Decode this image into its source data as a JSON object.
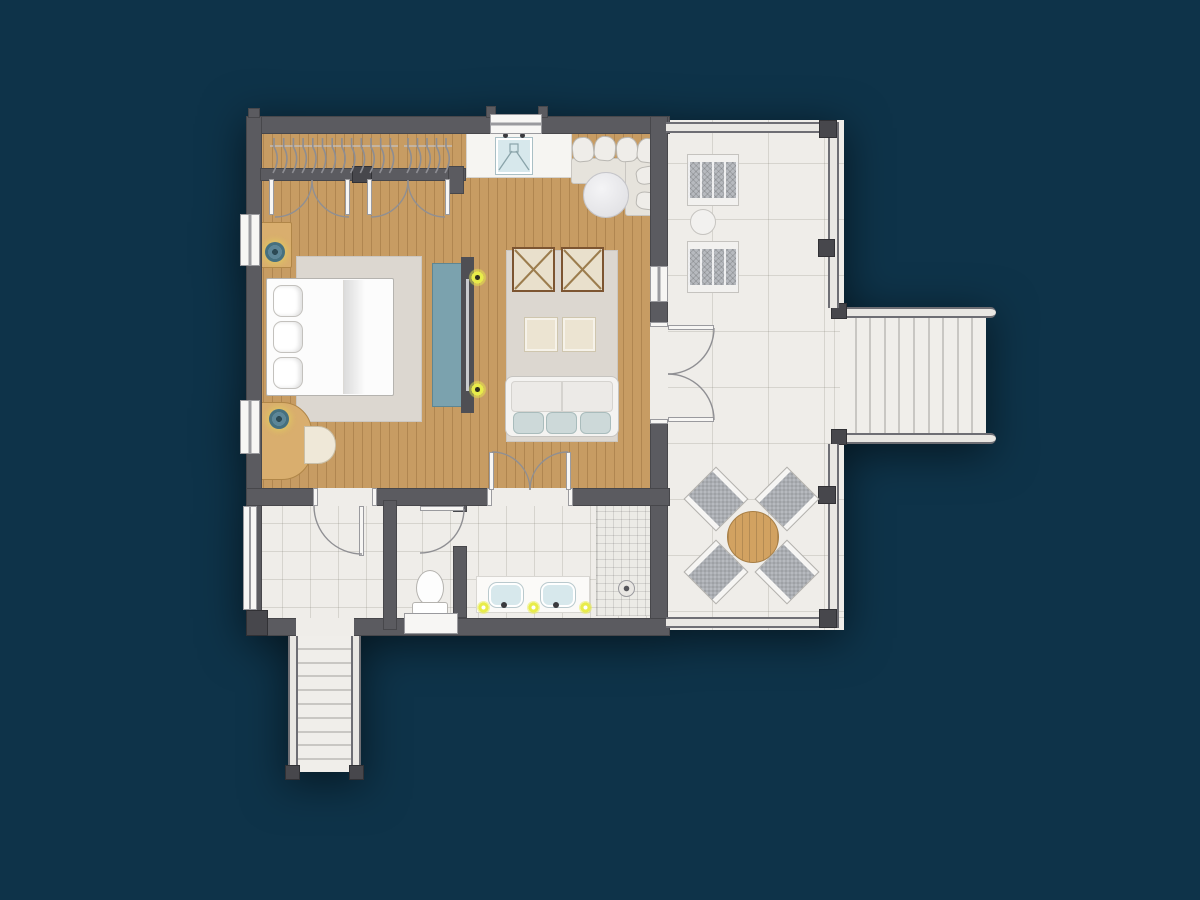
{
  "scene": {
    "kind": "architectural-floor-plan",
    "rooms": [
      "bedroom-living-room",
      "closet",
      "bathroom",
      "wc",
      "shower",
      "entry-landing",
      "terrace"
    ],
    "text_labels": []
  },
  "colors": {
    "background": "#0e3349",
    "wall": "#5b5b60",
    "wallDark": "#47474c",
    "wood": "#c79c63",
    "tile": "#efede9",
    "tileLine": "rgba(115,110,100,0.20)",
    "rug": "#dcd7d0",
    "white": "#f7f6f4",
    "trim": "#9a9a9e",
    "railing": "#6e6e74",
    "railingFill": "#e9e7e3",
    "stepLine": "#c9c7c3",
    "consoleTeal": "#7ba2ae",
    "tvDark": "#4f4f54",
    "furnitureWood": "#d9ae6e",
    "furnitureWoodEdge": "#b08648",
    "lampTeal": "#45707f",
    "cream": "#e9e0cc",
    "armchairFrame": "#7d5531",
    "cushionBlue": "#cdd9d9",
    "chairGray": "#b7babf",
    "sofaWhite": "#f4f3f1",
    "glowYellow": "#e8ec4a",
    "sinkBlue": "#d7e8ec",
    "diningWood": "#d2a261"
  },
  "closet": {
    "rail_y": 147,
    "hanger_groups": [
      {
        "x": 274,
        "count": 13,
        "spacing": 9.7
      },
      {
        "x": 408,
        "count": 5,
        "spacing": 9.5
      }
    ]
  },
  "stairs": {
    "right": {
      "steps": 10,
      "spacing": 14.6
    },
    "bottom": {
      "steps": 10,
      "spacing": 13.8
    }
  },
  "bed": {
    "pillow_count": 3,
    "pillow_offsets_y": [
      6,
      42,
      78
    ]
  },
  "sofa": {
    "cushion_count": 3,
    "cushion_offsets_x": [
      7,
      40,
      74
    ]
  },
  "vanity": {
    "sink_count": 2,
    "light_count": 3,
    "light_positions_x": [
      477,
      527,
      579
    ],
    "light_y": 601
  },
  "terrace": {
    "lounge_chair_count": 2,
    "lounge_chair_x": 688,
    "lounge_chair_y": [
      155,
      242
    ],
    "dining_chair_count": 4,
    "dining_chairs": [
      {
        "x": 694,
        "y": 477,
        "rot": -45
      },
      {
        "x": 765,
        "y": 477,
        "rot": 45
      },
      {
        "x": 694,
        "y": 550,
        "rot": 45
      },
      {
        "x": 765,
        "y": 550,
        "rot": -45
      }
    ]
  }
}
